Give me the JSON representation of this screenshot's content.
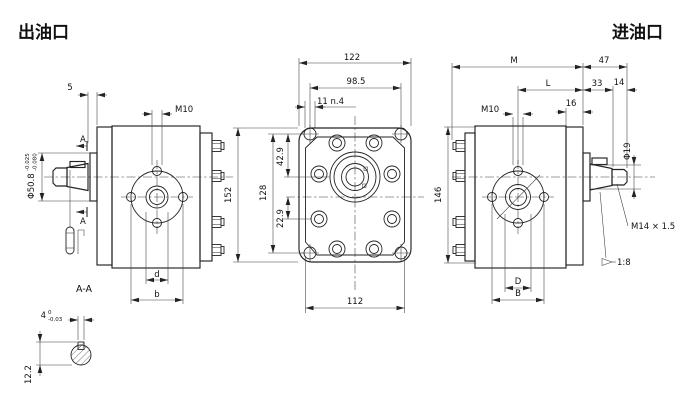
{
  "titles": {
    "outlet": "出油口",
    "inlet": "进油口"
  },
  "colors": {
    "line": "#232323",
    "text": "#111111",
    "background": "#ffffff"
  },
  "left_view": {
    "dim_offset": "5",
    "dim_thread": "M10",
    "pilot_dia": "Φ50.8",
    "pilot_tol_upper": "-0.025",
    "pilot_tol_lower": "-0.080",
    "section_letter_top": "A",
    "section_letter_bottom": "A",
    "dim_port_inner": "d",
    "dim_port_outer": "b"
  },
  "section_view": {
    "label": "A-A",
    "key_width": "4",
    "key_tol_upper": "0",
    "key_tol_lower": "-0.03",
    "key_depth": "12.2"
  },
  "front_view": {
    "dim_width": "122",
    "dim_hole_span_h": "98.5",
    "dim_hole_note": "11 n.4",
    "dim_height": "152",
    "dim_hole_span_v": "128",
    "dim_center_top": "42.9",
    "dim_center_bottom": "22.9",
    "dim_body_width": "112"
  },
  "right_view": {
    "dim_housing": "M",
    "dim_shaft_ext": "47",
    "dim_L": "L",
    "dim_taper_len": "33",
    "dim_thread_len": "14",
    "dim_flange_thk": "16",
    "dim_thread": "M10",
    "dim_shaft_dia": "Φ19",
    "dim_shaft_thread": "M14 × 1.5",
    "taper_ratio": "1:8",
    "dim_port_inner": "D",
    "dim_port_outer": "B",
    "dim_height": "146"
  }
}
